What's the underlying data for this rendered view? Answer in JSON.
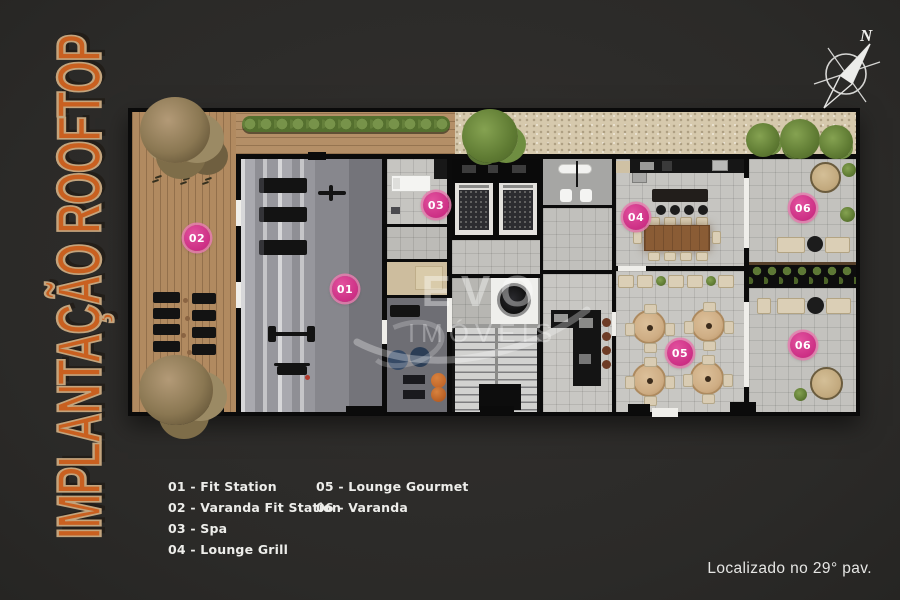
{
  "title": "IMPLANTAÇÃO ROOFTOP",
  "compass": {
    "label": "N"
  },
  "watermark": {
    "brand": "EVO",
    "suffix": "IMÓVEIS"
  },
  "markers": [
    {
      "label": "01"
    },
    {
      "label": "02"
    },
    {
      "label": "03"
    },
    {
      "label": "04"
    },
    {
      "label": "05"
    },
    {
      "label": "06"
    },
    {
      "label": "06"
    }
  ],
  "legend": {
    "col1": [
      "01 - Fit Station",
      "02 - Varanda Fit Station",
      "03 - Spa",
      "04 - Lounge Grill"
    ],
    "col2": [
      "05 - Lounge Gourmet",
      "06 - Varanda"
    ]
  },
  "footer": {
    "note": "Localizado no 29° pav."
  },
  "colors": {
    "accent_pink": "#cc2e84",
    "title_orange": "#c96020",
    "background": "#2b2a28"
  }
}
